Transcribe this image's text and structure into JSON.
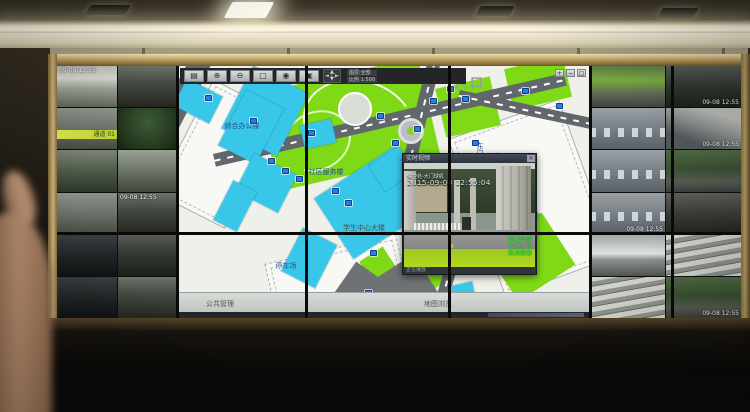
{
  "wall": {
    "left_tiles": [
      {
        "scene": "building-white",
        "osd": "09-08 12:55"
      },
      {
        "scene": "alley"
      },
      {
        "scene": "street",
        "banner": "通道 01"
      },
      {
        "scene": "trees"
      },
      {
        "scene": "courtyard"
      },
      {
        "scene": "path"
      },
      {
        "scene": "street"
      },
      {
        "scene": "alley",
        "osd": "09-08 12:55"
      },
      {
        "scene": "garage"
      },
      {
        "scene": "street-dark"
      },
      {
        "scene": "garage"
      },
      {
        "scene": "alley"
      }
    ],
    "right_tiles": [
      {
        "scene": "lawn"
      },
      {
        "scene": "street-dark",
        "osd": "09-08 12:55",
        "pos": "br"
      },
      {
        "scene": "parking"
      },
      {
        "scene": "ramp",
        "osd": "09-08 12:55",
        "pos": "br"
      },
      {
        "scene": "parking"
      },
      {
        "scene": "trees-street"
      },
      {
        "scene": "parking",
        "osd": "09-08 12:55",
        "pos": "br"
      },
      {
        "scene": "building-dark"
      },
      {
        "scene": "car-close"
      },
      {
        "scene": "stairs"
      },
      {
        "scene": "stairs"
      },
      {
        "scene": "trees-street",
        "osd": "09-08 12:55",
        "pos": "br"
      }
    ],
    "map": {
      "toolbar": {
        "buttons": [
          {
            "glyph": "▤",
            "name": "layers-icon"
          },
          {
            "glyph": "⊕",
            "name": "zoom-in-icon"
          },
          {
            "glyph": "⊖",
            "name": "zoom-out-icon"
          },
          {
            "glyph": "□",
            "name": "select-icon"
          },
          {
            "glyph": "◉",
            "name": "locate-icon"
          },
          {
            "glyph": "▣",
            "name": "video-icon"
          }
        ],
        "dpad": {
          "up": "▲",
          "down": "▼",
          "left": "◄",
          "right": "►",
          "center": "□"
        },
        "info1": "图层:全部",
        "info2": "比例 1:500"
      },
      "corner_buttons": [
        {
          "glyph": "+",
          "name": "zoom-in-icon"
        },
        {
          "glyph": "−",
          "name": "zoom-out-icon"
        },
        {
          "glyph": "□",
          "name": "fullscreen-icon"
        }
      ],
      "labels": [
        {
          "text": "入口",
          "x": 292,
          "y": 16,
          "cls": "big"
        },
        {
          "text": "学生中心大楼",
          "x": 186,
          "y": 162,
          "cls": "dark"
        },
        {
          "text": "社区服务楼",
          "x": 148,
          "y": 106,
          "cls": ""
        },
        {
          "text": "综合办公楼",
          "x": 64,
          "y": 60,
          "cls": ""
        },
        {
          "text": "东门值班室",
          "x": 302,
          "y": 94,
          "cls": "vert"
        },
        {
          "text": "停车场",
          "x": 108,
          "y": 200,
          "cls": ""
        }
      ],
      "markers": [
        [
          72,
          52
        ],
        [
          90,
          92
        ],
        [
          104,
          102
        ],
        [
          118,
          110
        ],
        [
          154,
          122
        ],
        [
          167,
          134
        ],
        [
          192,
          184
        ],
        [
          199,
          47
        ],
        [
          214,
          74
        ],
        [
          252,
          32
        ],
        [
          269,
          20
        ],
        [
          284,
          30
        ],
        [
          294,
          74
        ],
        [
          300,
          99
        ],
        [
          306,
          124
        ],
        [
          344,
          22
        ],
        [
          378,
          37
        ],
        [
          187,
          224
        ],
        [
          240,
          186
        ],
        [
          27,
          29
        ],
        [
          130,
          64
        ],
        [
          236,
          60
        ]
      ],
      "status": {
        "left": "公共管理",
        "right": "地图浏览"
      }
    },
    "popup": {
      "title": "实时视频",
      "close_glyph": "×",
      "channel": "保卫处-大门球机",
      "timestamp": "2015-09-08 12:55:04",
      "osd": [
        "出口车道",
        "大门广场",
        "高清摄像"
      ],
      "footer": "正在播放"
    }
  }
}
